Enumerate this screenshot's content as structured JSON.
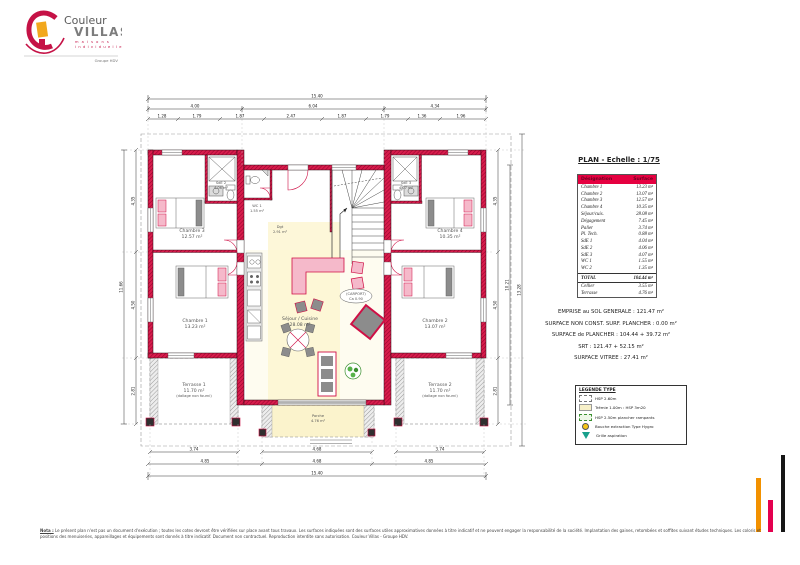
{
  "colors": {
    "wall_crimson": "#d81c4c",
    "wall_hatch": "#96032c",
    "furniture_pink": "#f5b9ca",
    "accent_crimson": "#cf0f45",
    "zone_yellow": "#fdf6cf",
    "table_header": "#e50040",
    "bar_orange": "#f29100",
    "bar_pink": "#e4004f",
    "bar_black": "#161616"
  },
  "logo": {
    "brand_top": "Couleur",
    "brand_bottom": "VILLAS",
    "tagline1": "m a i s o n s",
    "tagline2": "i n d i v i d u e l l e s",
    "group": "Groupe HDV"
  },
  "plan": {
    "title": "PLAN - Echelle : 1/75",
    "labels": {
      "chambre1": {
        "name": "Chambre 1",
        "area": "13.23 m²"
      },
      "chambre2": {
        "name": "Chambre 2",
        "area": "13.07 m²"
      },
      "chambre3": {
        "name": "Chambre 3",
        "area": "12.57 m²"
      },
      "chambre4": {
        "name": "Chambre 4",
        "area": "10.35 m²"
      },
      "sde2": {
        "name": "SdE 2",
        "area": "4.06 m²"
      },
      "sde3": {
        "name": "SdE 3",
        "area": "4.07 m²"
      },
      "wc1": {
        "name": "WC 1",
        "area": "1.55 m²"
      },
      "dgt": {
        "name": "Dgt",
        "area": "2.91 m²"
      },
      "sejour": {
        "name": "Séjour / Cuisine",
        "area": "28.08 m²"
      },
      "carport": {
        "line1": "(CARPORT)",
        "line2": "Ca 0.90"
      },
      "terrasse1": {
        "name": "Terrasse 1",
        "area": "11.70 m²",
        "note": "(dallage non fourni)"
      },
      "terrasse2": {
        "name": "Terrasse 2",
        "area": "11.70 m²",
        "note": "(dallage non fourni)"
      },
      "porche": {
        "name": "Porche",
        "area": "4.76 m²"
      }
    },
    "dims": {
      "top_total": "15.40",
      "top_l": "4.00",
      "top_c": "6.04",
      "top_r": "4.34",
      "ts": [
        "1.28",
        "1.79",
        "1.87",
        "2.47",
        "1.87",
        "1.79",
        "1.36",
        "1.96"
      ],
      "bot_l": "3.74",
      "bot_c": "4.68",
      "bot_r": "3.74",
      "bot_l2": "4.85",
      "bot_c2": "4.68",
      "bot_r2": "4.85",
      "bot_total": "15.40",
      "left_1": "4.35",
      "left_2": "4.50",
      "left_3": "2.81",
      "left_total": "11.66",
      "right_1": "4.35",
      "right_2": "4.50",
      "right_3": "2.81",
      "right_total": "10.21",
      "right_grand": "13.28"
    }
  },
  "panel": {
    "table": {
      "header": {
        "col1": "Désignation",
        "col2": "Surface"
      },
      "rows": [
        {
          "label": "Chambre 1",
          "value": "13.23 m²"
        },
        {
          "label": "Chambre 2",
          "value": "13.07 m²"
        },
        {
          "label": "Chambre 3",
          "value": "12.57 m²"
        },
        {
          "label": "Chambre 4",
          "value": "10.35 m²"
        },
        {
          "label": "Séjour/cuis.",
          "value": "28.08 m²"
        },
        {
          "label": "Dégagement",
          "value": "7.45 m²"
        },
        {
          "label": "Palier",
          "value": "3.74 m²"
        },
        {
          "label": "Pl. Tech.",
          "value": "0.88 m²"
        },
        {
          "label": "SdE 1",
          "value": "4.04 m²"
        },
        {
          "label": "SdE 2",
          "value": "4.06 m²"
        },
        {
          "label": "SdE 3",
          "value": "4.07 m²"
        },
        {
          "label": "WC 1",
          "value": "1.55 m²"
        },
        {
          "label": "WC 2",
          "value": "1.35 m²"
        }
      ],
      "total": {
        "label": "TOTAL",
        "value": "104.44 m²"
      },
      "extra": [
        {
          "label": "Cellier",
          "value": "3.55 m²"
        },
        {
          "label": "Terrasse",
          "value": "4.76 m²"
        }
      ]
    },
    "surfaces": [
      "EMPRISE au SOL GENERALE : 121.47 m²",
      "SURFACE NON CONST. SURF. PLANCHER : 0.00 m²",
      "SURFACE de PLANCHER : 104.44 + 39.72 m²",
      "SRT : 121.47 + 52.15 m²",
      "SURFACE VITREE : 27.41 m²"
    ],
    "legend": {
      "title": "LEGENDE TYPE",
      "items": [
        {
          "label": "HSP 2.60m"
        },
        {
          "label": "Trémie 1.00m : HSP 3m20"
        },
        {
          "label": "HSP 2.50m plancher rampants"
        },
        {
          "label": "Bouche extraction Type Hygro"
        },
        {
          "label": "Grille aspiration"
        }
      ]
    }
  },
  "footer": {
    "nota_label": "Nota :",
    "line1": "Le présent plan n'est pas un document d'exécution ; toutes les cotes devront être vérifiées sur place avant tous travaux. Les surfaces indiquées sont des surfaces utiles approximatives données à titre indicatif et ne peuvent engager la responsabilité de la société. Implantation des gaines, retombées et soffites suivant études techniques.",
    "line2": "Les coloris et positions des menuiseries, appareillages et équipements sont donnés à titre indicatif. Document non contractuel. Reproduction interdite sans autorisation. Couleur Villas - Groupe HDV."
  }
}
